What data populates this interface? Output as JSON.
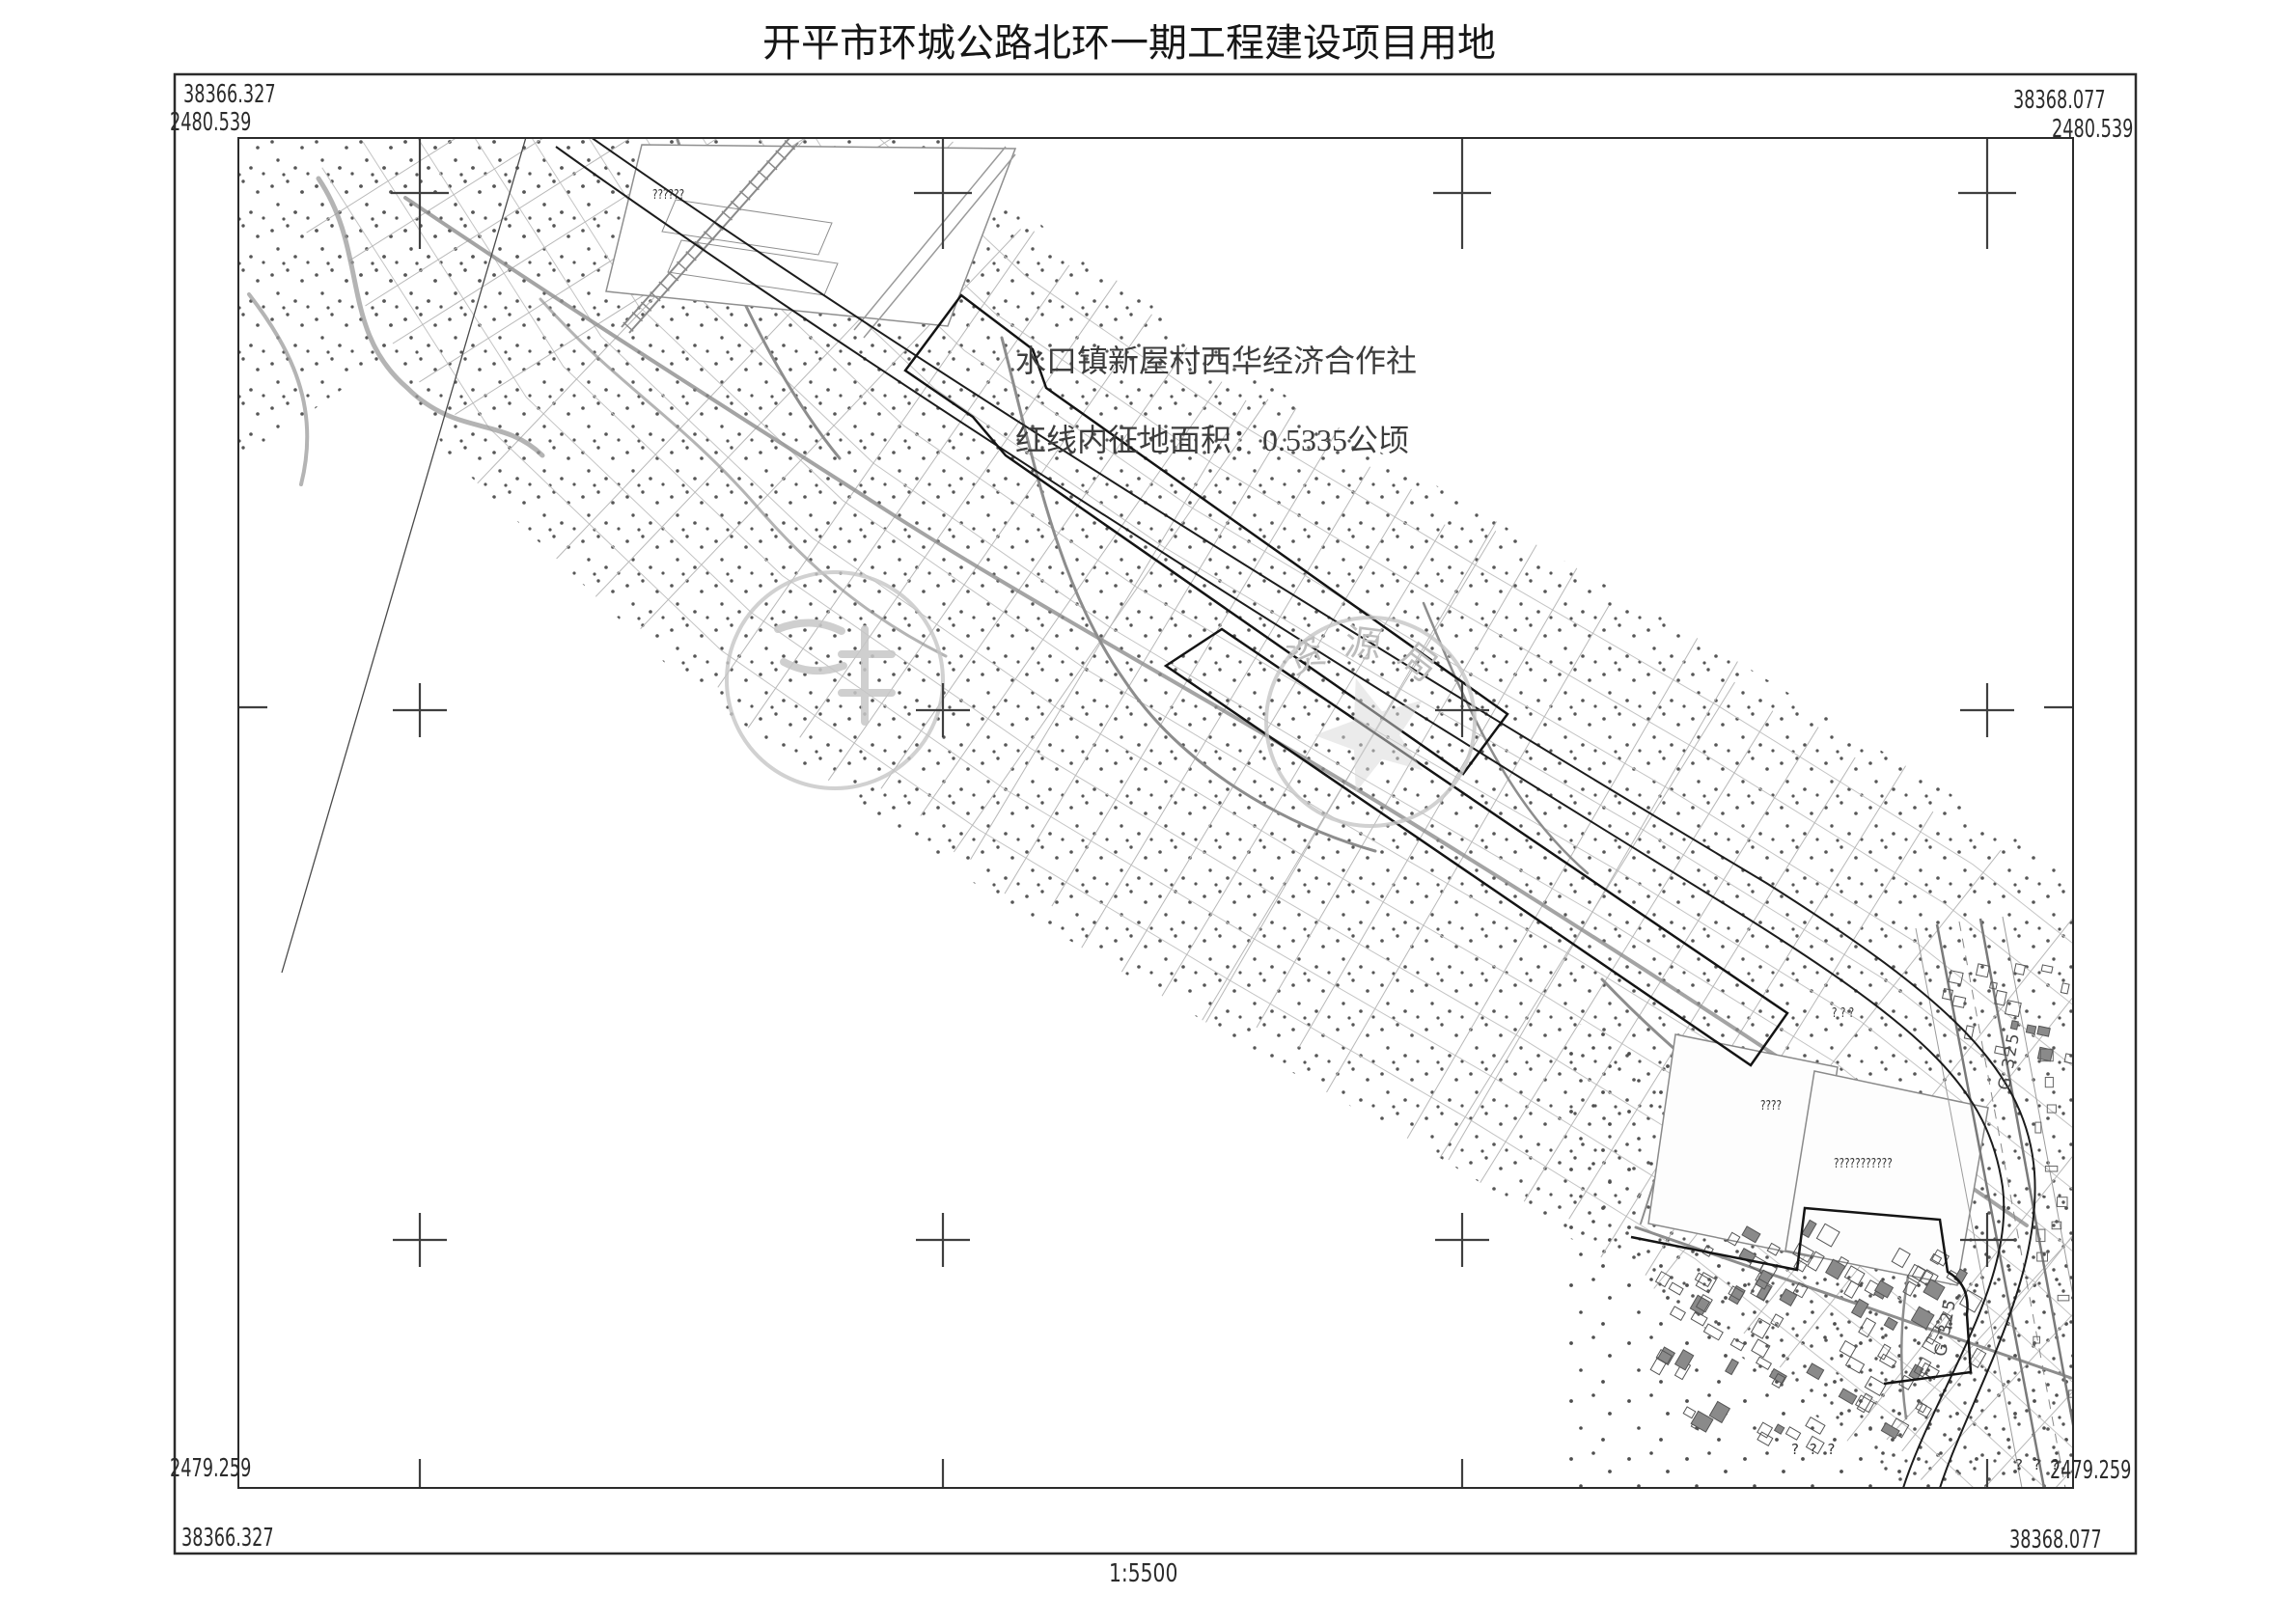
{
  "title": "开平市环城公路北环一期工程建设项目用地",
  "scale_label": "1:5500",
  "frame_coords": {
    "top_left": {
      "easting": "38366.327",
      "northing": "2480.539"
    },
    "top_right": {
      "easting": "38368.077",
      "northing": "2480.539"
    },
    "bottom_left": {
      "easting": "38366.327",
      "northing": "2479.259"
    },
    "bottom_right": {
      "easting": "38368.077",
      "northing": "2479.259"
    }
  },
  "annotation": {
    "line1": "水口镇新屋村西华经济合作社",
    "line2": "红线内征地面积：0.5335公顷"
  },
  "seals": {
    "right": {
      "characters": "资源局"
    }
  },
  "map_labels": {
    "factory": "??????",
    "parcel_short": "????",
    "parcel_long": "???????????",
    "marks_a": "? ? ?",
    "marks_b": "? ? ?",
    "marks_c": "? ? ?",
    "highway_a": "G 325",
    "highway_b": "G 325"
  },
  "colors": {
    "ink": "#161616",
    "stipple": "#565656",
    "mesh": "#bdbdbd",
    "road": "#8d8d8d",
    "seal": "#c6c6c6"
  }
}
